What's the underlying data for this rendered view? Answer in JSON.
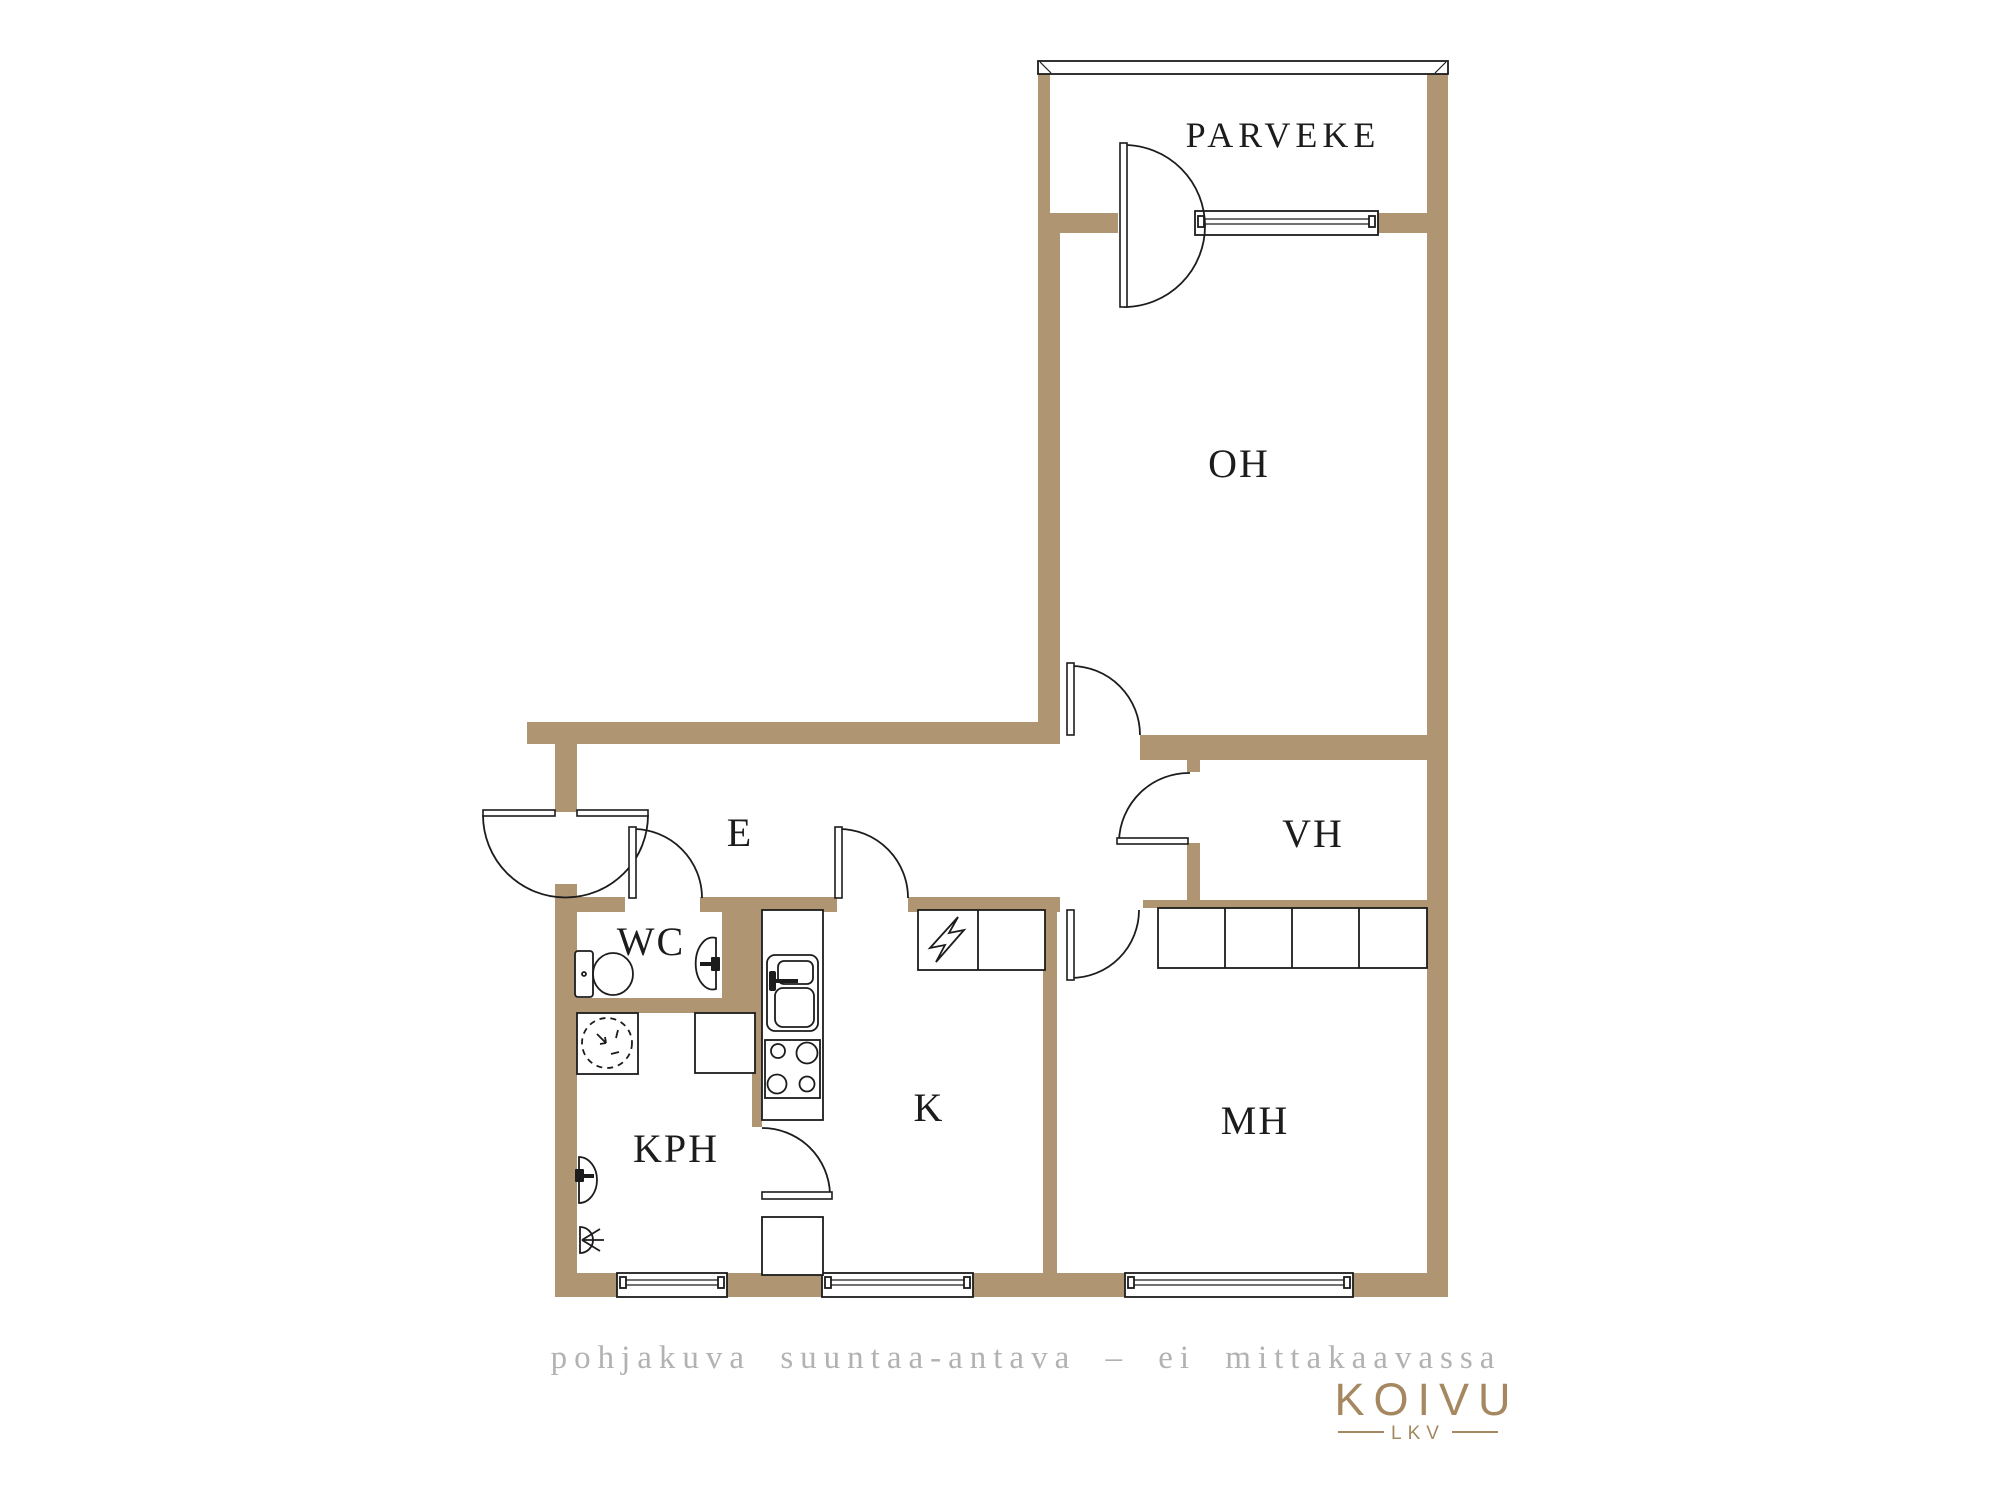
{
  "colors": {
    "wall": "#af9572",
    "line": "#1c1c1c",
    "caption": "#b2b2b2",
    "brand": "#a5885f",
    "bg": "#ffffff"
  },
  "rooms": {
    "parveke": {
      "label": "PARVEKE"
    },
    "oh": {
      "label": "OH"
    },
    "vh": {
      "label": "VH"
    },
    "e": {
      "label": "E"
    },
    "wc": {
      "label": "WC"
    },
    "kph": {
      "label": "KPH"
    },
    "k": {
      "label": "K"
    },
    "mh": {
      "label": "MH"
    }
  },
  "fixtures": [
    "toilet",
    "wc-sink",
    "washing-machine",
    "utility-cabinet",
    "kph-sink",
    "floor-drain",
    "kitchen-counter",
    "kitchen-sink",
    "stove",
    "electrical-cabinet",
    "kitchen-cabinet",
    "mh-closets",
    "balcony-railing"
  ],
  "windows": [
    "balcony-window",
    "kph-window",
    "kitchen-window",
    "mh-window"
  ],
  "doors": [
    "entrance-door",
    "wc-door",
    "kitchen-door",
    "oh-door",
    "vh-door",
    "mh-door",
    "kph-door",
    "balcony-door"
  ],
  "footer": {
    "caption": "pohjakuva suuntaa-antava – ei mittakaavassa",
    "brand": "KOIVU",
    "brand_sub": "LKV"
  }
}
